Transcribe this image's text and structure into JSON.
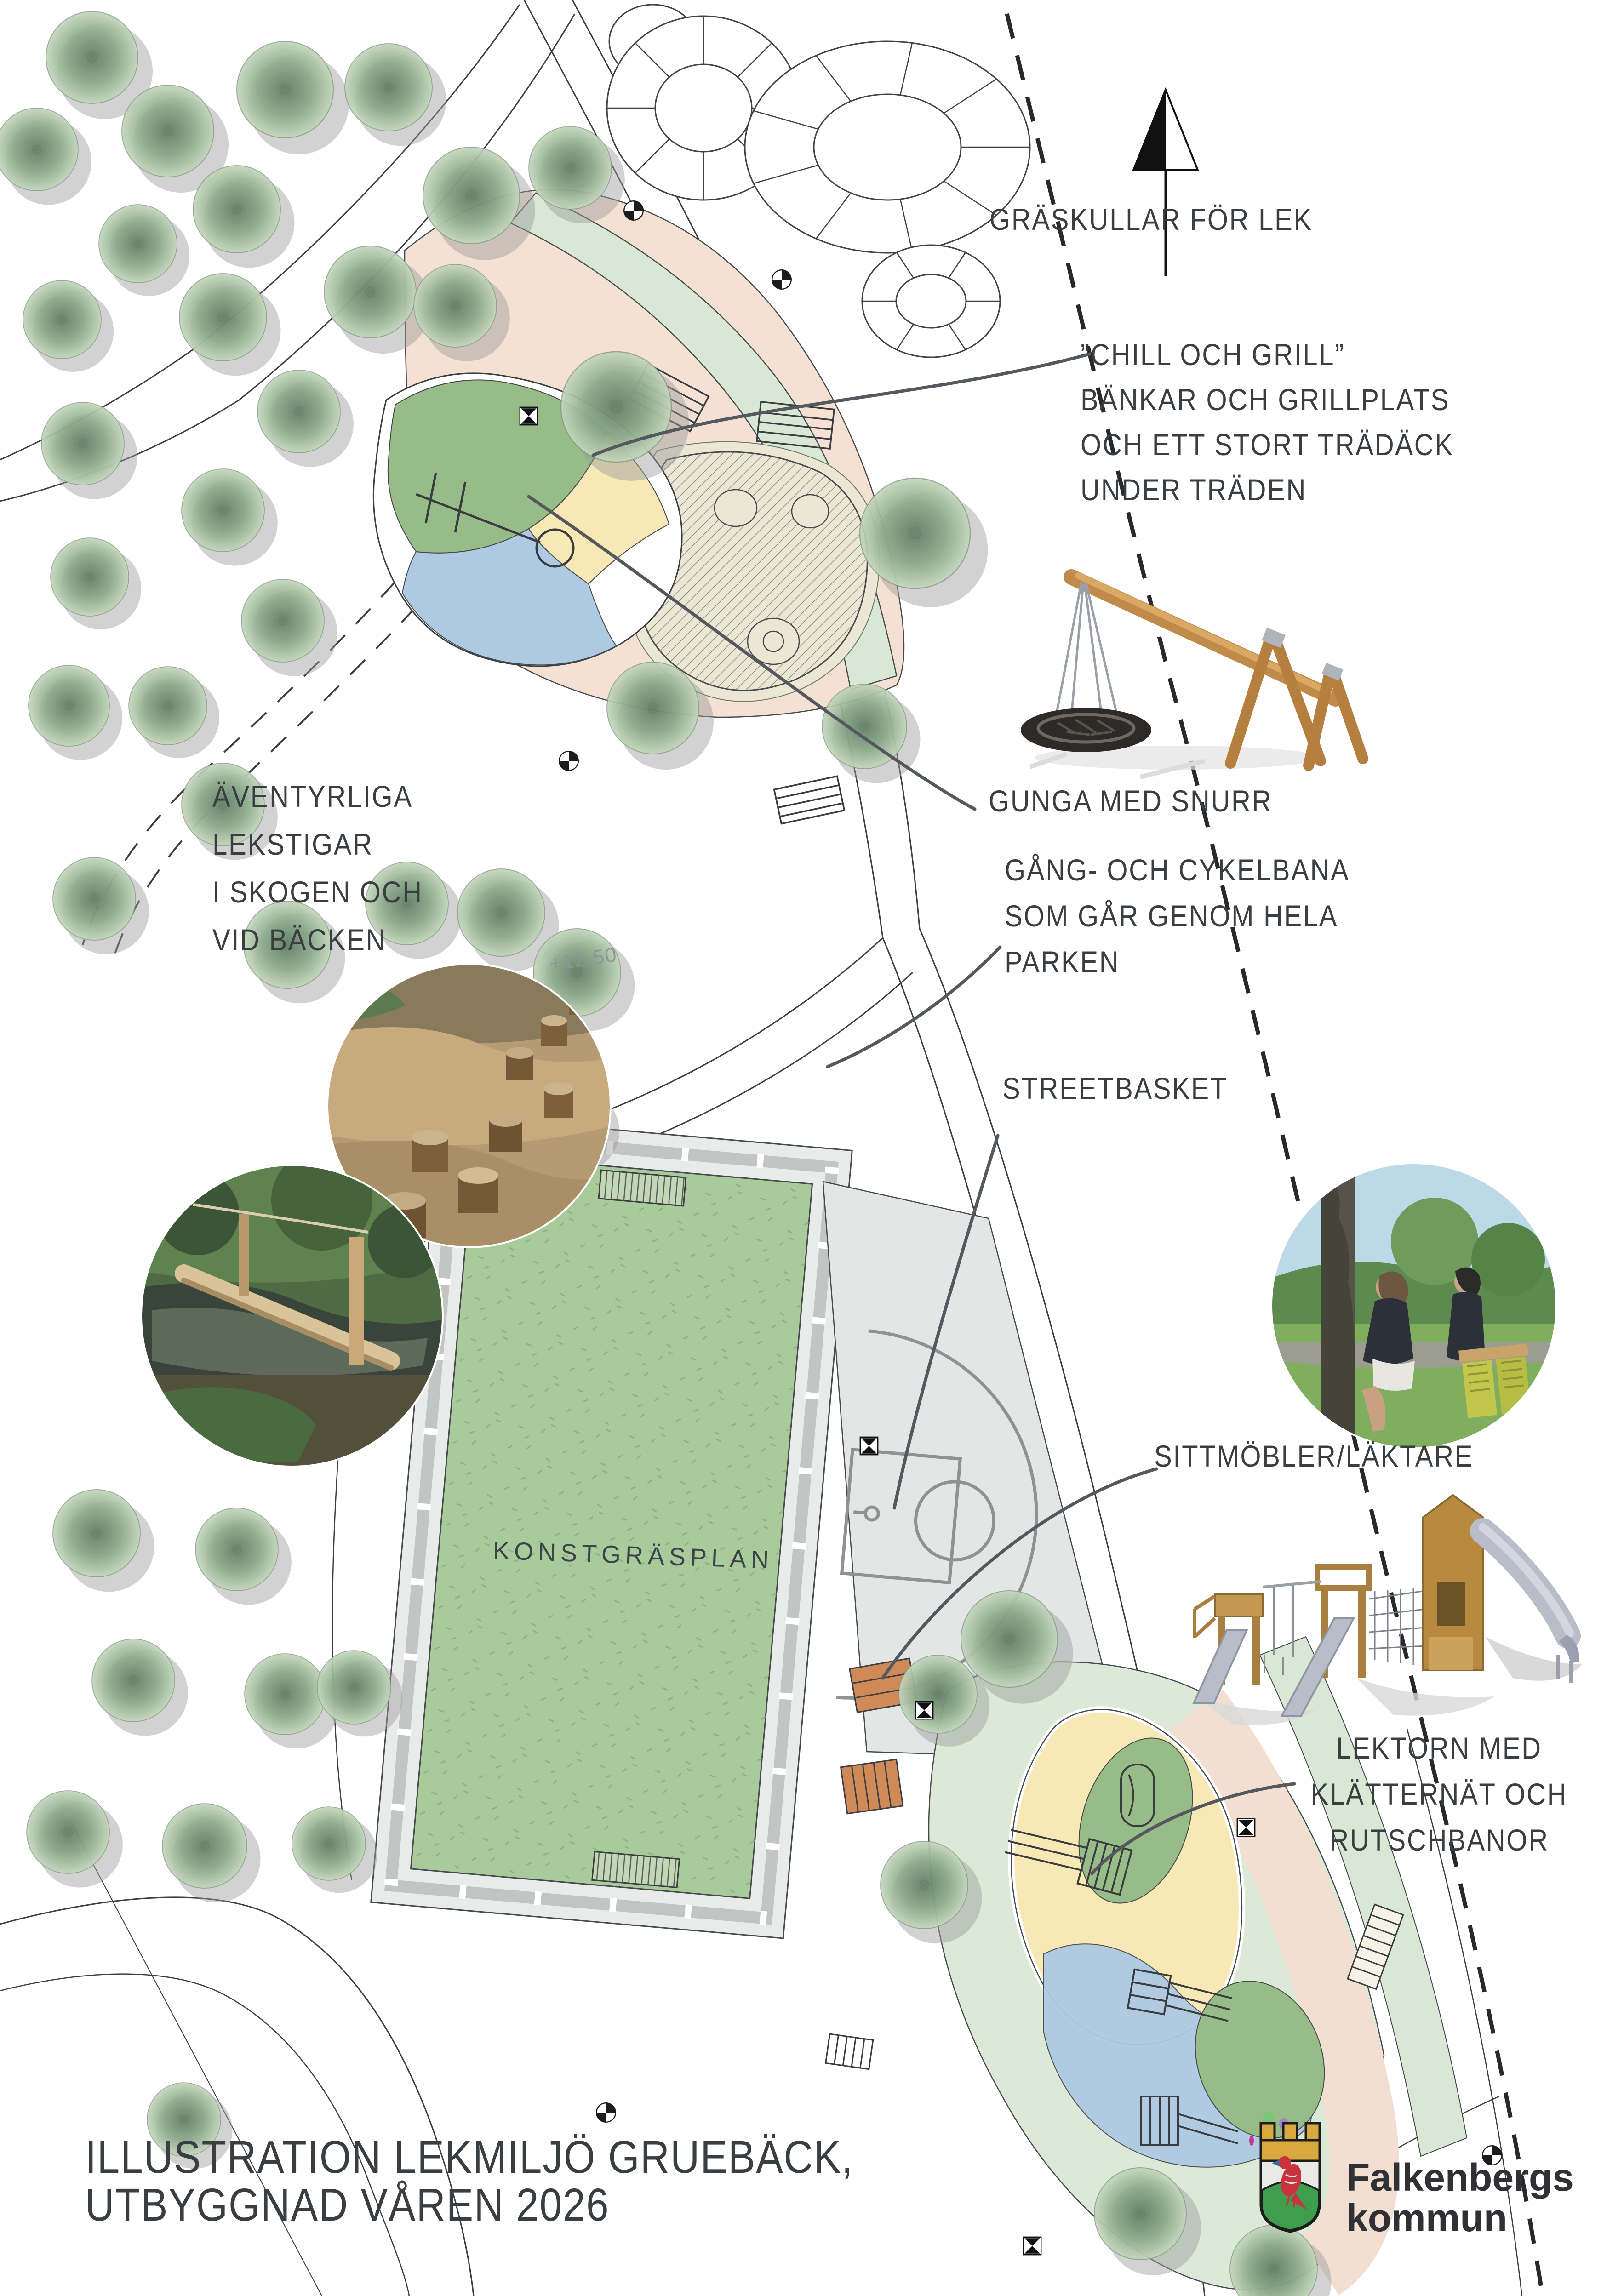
{
  "map": {
    "labels": {
      "graskullar": "GRÄSKULLAR FÖR LEK",
      "chill_line1": "”CHILL OCH GRILL”",
      "chill_line2": "BÄNKAR OCH GRILLPLATS",
      "chill_line3": "OCH ETT STORT TRÄDÄCK",
      "chill_line4": "UNDER TRÄDEN",
      "gunga": "GUNGA MED SNURR",
      "gang_line1": "GÅNG- OCH CYKELBANA",
      "gang_line2": "SOM GÅR GENOM HELA",
      "gang_line3": "PARKEN",
      "streetbasket": "STREETBASKET",
      "sittmobler": "SITTMÖBLER/LÄKTARE",
      "lektorn_line1": "LEKTORN MED",
      "lektorn_line2": "KLÄTTERNÄT OCH",
      "lektorn_line3": "RUTSCHBANOR",
      "aventyr_line1": "ÄVENTYRLIGA",
      "aventyr_line2": "LEKSTIGAR",
      "aventyr_line3": "I SKOGEN OCH",
      "aventyr_line4": "VID BÄCKEN",
      "konstgras": "KONSTGRÄSPLAN",
      "elevation": "+12.50"
    },
    "title_line1": "ILLUSTRATION LEKMILJÖ GRUEBÄCK,",
    "title_line2": "UTBYGGNAD VÅREN 2026",
    "logo_line1": "Falkenbergs",
    "logo_line2": "kommun",
    "colors": {
      "turf_green": "#a9cb9c",
      "light_green_strip": "#d9e8d4",
      "playground_peach": "#f4e1d4",
      "sand_yellow": "#f8e8b6",
      "water_blue": "#aec9e2",
      "mound_green": "#97bc88",
      "court_gray": "#e4e5e5",
      "bench_orange": "#d08a58",
      "annotation_text": "#3a3e41",
      "logo_red": "#c8333f",
      "logo_gold": "#d9a940",
      "logo_green": "#3f9e4d"
    }
  }
}
